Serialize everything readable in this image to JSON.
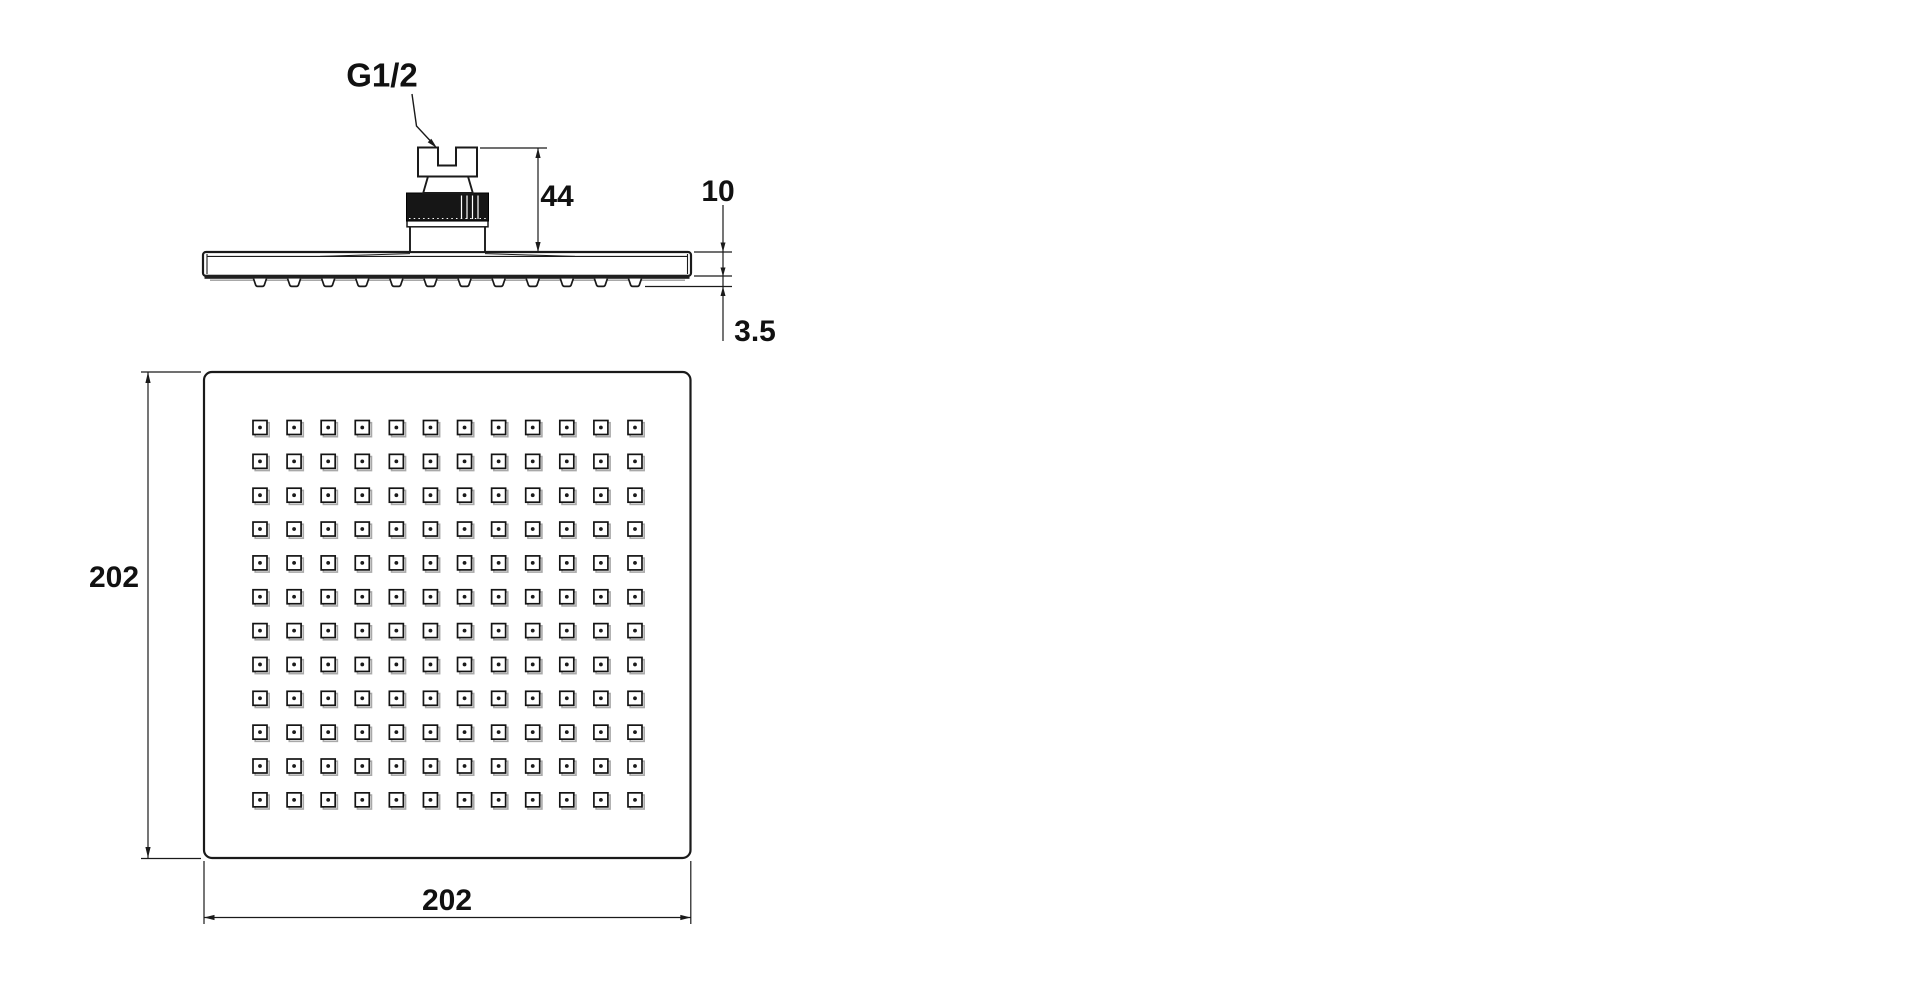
{
  "drawing": {
    "background_color": "#ffffff",
    "line_color": "#1a1a1a",
    "knurl_color": "#161616",
    "shadow_color": "#a9a9a9",
    "labels": {
      "thread_size": "G1/2",
      "connector_height": "44",
      "plate_thickness": "10",
      "nozzle_protrusion": "3.5",
      "face_height": "202",
      "face_width": "202"
    },
    "face_view": {
      "nozzle_rows": 12,
      "nozzle_cols": 12
    },
    "side_view": {
      "nozzle_count": 12
    }
  }
}
